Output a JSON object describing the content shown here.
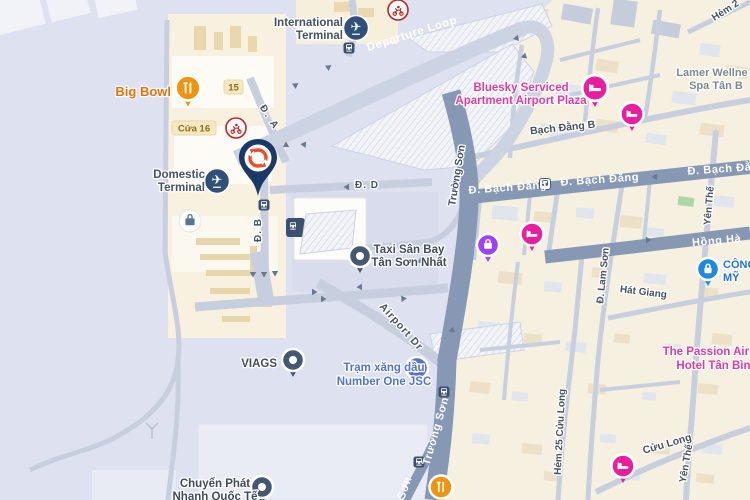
{
  "view": {
    "width": 750,
    "height": 500,
    "type": "map-viewport"
  },
  "roads": {
    "departure_loop": "Departure Loop",
    "truong_son": "Trường Sơn",
    "truong_son_partial": "Sơn",
    "bach_dang": "Đ. Bạch Đằng",
    "bach_dang_b": "Bạch Đằng B",
    "hong_ha": "Hồng Hà",
    "yen_the": "Yên Thế",
    "lam_son": "Đ. Lam Sơn",
    "hat_giang": "Hát Giang",
    "cuu_long": "Cửu Long",
    "hem_25_cuu_long": "Hẻm 25 Cửu Long",
    "hem_2": "Hẻm 2",
    "airport_dr": "Airport Dr",
    "d_a": "Đ. A",
    "d_b": "Đ. B",
    "d_d": "Đ. D"
  },
  "pois": {
    "international_terminal": {
      "line1": "International",
      "line2": "Terminal"
    },
    "domestic_terminal": {
      "line1": "Domestic",
      "line2": "Terminal"
    },
    "big_bowl": {
      "label": "Big Bowl"
    },
    "taxi_san_bay": {
      "line1": "Taxi Sân Bay",
      "line2": "Tân Sơn Nhất"
    },
    "viags": {
      "label": "VIAGS"
    },
    "tram_xang_dau": {
      "line1": "Trạm xăng dầu",
      "line2": "Number One JSC"
    },
    "chuyen_phat": {
      "line1": "Chuyển Phát",
      "line2": "Nhanh Quốc Tế"
    },
    "bluesky": {
      "line1": "Bluesky Serviced",
      "line2": "Apartment Airport Plaza"
    },
    "lamer": {
      "line1": "Lamer Wellne",
      "line2": "Spa Tân B"
    },
    "passion": {
      "line1": "The Passion Airport",
      "line2": "Hotel Tân Bình"
    },
    "cong_my": {
      "line1": "CÔNG",
      "line2": "MỸ"
    }
  },
  "badges": {
    "gate_15": "15",
    "cua_16": "Cửa 16"
  },
  "icons": {
    "selected_marker": "sync-arrows-pin",
    "hotel": "bed-pin",
    "restaurant": "fork-knife-pin",
    "gas_station": "fuel-pump-pin",
    "security": "lock-pin",
    "shopping": "bag-pin",
    "transit_stop": "bus-icon",
    "terminal": "airplane-icon",
    "baggage": "suitcase-icon",
    "motorbike_point": "scooter-icon",
    "generic_place": "dot-pin"
  },
  "colors": {
    "map_land": "#f6f0e1",
    "map_airport": "#dde1f0",
    "road_major": "#8798b4",
    "road_minor": "#c7cfdf",
    "label_dark": "#47525f",
    "poi_pink": "#e5399e",
    "poi_blue": "#5271d1",
    "poi_orange": "#e8710a",
    "poi_link_blue": "#1a73e8",
    "pin_navy": "#1c3866",
    "logo_orange": "#ee4d23"
  }
}
